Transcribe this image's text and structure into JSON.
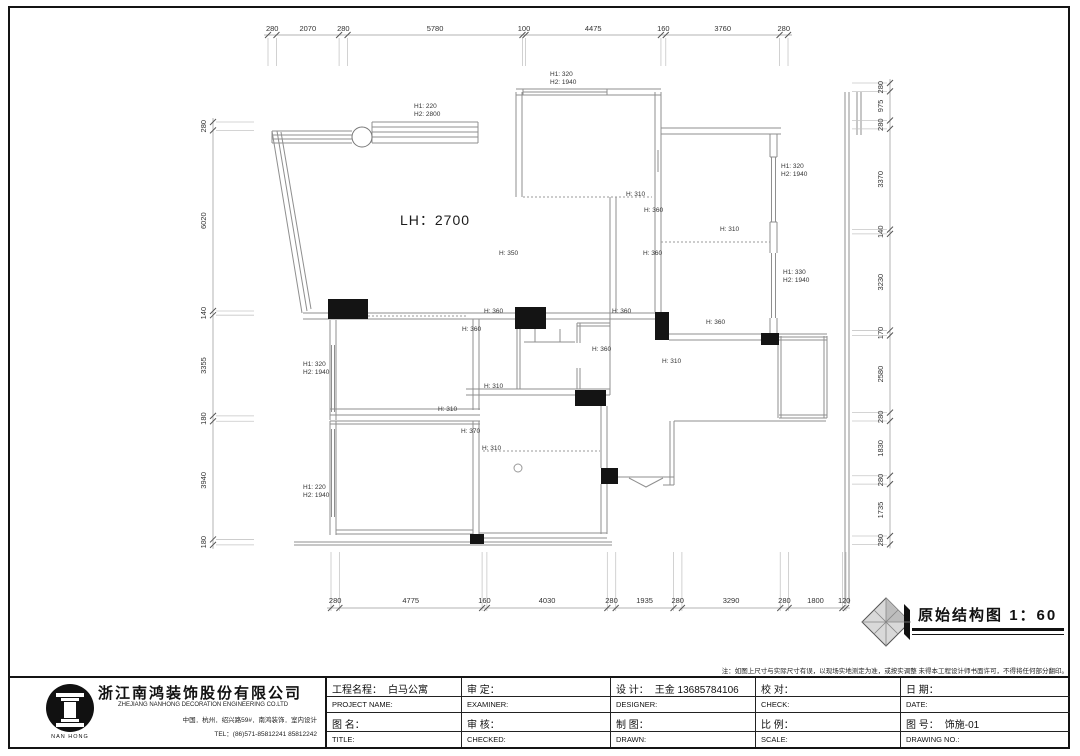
{
  "sheet": {
    "note": "注：如图上尺寸与实际尺寸有误，以现场实地测定为准，或按实调整 未得本工程设计师书面许可，不得将任何部分翻印。",
    "stamp": {
      "title": "原始结构图",
      "scale": "1：60"
    },
    "company": {
      "logo_text": "NAN HONG",
      "name": "浙江南鸿装饰股份有限公司",
      "name_en": "ZHEJIANG NANHONG DECORATION ENGINEERING CO.LTD",
      "address": "中国．杭州．绍兴路59#．南鸿装饰．室内设计",
      "tel": "TEL：(86)571-85812241 85812242"
    },
    "title_block": {
      "rows": [
        {
          "cls": "cn",
          "cells": [
            {
              "label": "工程名程：",
              "value": "白马公寓"
            },
            {
              "label": "审  定：",
              "value": ""
            },
            {
              "label": "设  计：",
              "value": "王金 13685784106"
            },
            {
              "label": "校  对：",
              "value": ""
            },
            {
              "label": "日  期：",
              "value": ""
            }
          ]
        },
        {
          "cls": "en",
          "cells": [
            {
              "label": "PROJECT NAME:",
              "value": ""
            },
            {
              "label": "EXAMINER:",
              "value": ""
            },
            {
              "label": "DESIGNER:",
              "value": ""
            },
            {
              "label": "CHECK:",
              "value": ""
            },
            {
              "label": "DATE:",
              "value": ""
            }
          ]
        },
        {
          "cls": "cn",
          "cells": [
            {
              "label": "图 名：",
              "value": ""
            },
            {
              "label": "审  核：",
              "value": ""
            },
            {
              "label": "制  图：",
              "value": ""
            },
            {
              "label": "比  例：",
              "value": ""
            },
            {
              "label": "图  号：",
              "value": "饰施-01"
            }
          ]
        },
        {
          "cls": "en",
          "cells": [
            {
              "label": "TITLE:",
              "value": ""
            },
            {
              "label": "CHECKED:",
              "value": ""
            },
            {
              "label": "DRAWN:",
              "value": ""
            },
            {
              "label": "SCALE:",
              "value": ""
            },
            {
              "label": "DRAWING NO.:",
              "value": ""
            }
          ]
        }
      ]
    }
  },
  "plan": {
    "lh_label": "LH：2700",
    "dims": {
      "top": [
        280,
        2070,
        280,
        5780,
        100,
        4475,
        160,
        3760,
        280
      ],
      "bottom": [
        280,
        4775,
        160,
        4030,
        280,
        1935,
        280,
        3290,
        280,
        1800,
        120
      ],
      "left": [
        280,
        6020,
        140,
        3355,
        180,
        3940,
        180
      ],
      "right": [
        280,
        975,
        280,
        3370,
        140,
        3230,
        170,
        2580,
        280,
        1830,
        280,
        1735,
        280
      ]
    },
    "height_labels": [
      {
        "x": 414,
        "y": 103,
        "lines": [
          "H1: 220",
          "H2: 2800"
        ]
      },
      {
        "x": 550,
        "y": 71,
        "lines": [
          "H1: 320",
          "H2: 1940"
        ]
      },
      {
        "x": 781,
        "y": 163,
        "lines": [
          "H1: 320",
          "H2: 1940"
        ]
      },
      {
        "x": 783,
        "y": 269,
        "lines": [
          "H1: 330",
          "H2: 1940"
        ]
      },
      {
        "x": 303,
        "y": 361,
        "lines": [
          "H1: 320",
          "H2: 1940"
        ]
      },
      {
        "x": 303,
        "y": 484,
        "lines": [
          "H1: 220",
          "H2: 1940"
        ]
      },
      {
        "x": 626,
        "y": 191,
        "lines": [
          "H: 310"
        ]
      },
      {
        "x": 644,
        "y": 207,
        "lines": [
          "H: 360"
        ]
      },
      {
        "x": 643,
        "y": 250,
        "lines": [
          "H: 360"
        ]
      },
      {
        "x": 720,
        "y": 226,
        "lines": [
          "H: 310"
        ]
      },
      {
        "x": 499,
        "y": 250,
        "lines": [
          "H: 350"
        ]
      },
      {
        "x": 462,
        "y": 326,
        "lines": [
          "H: 360"
        ]
      },
      {
        "x": 484,
        "y": 308,
        "lines": [
          "H: 360"
        ]
      },
      {
        "x": 612,
        "y": 308,
        "lines": [
          "H: 360"
        ]
      },
      {
        "x": 592,
        "y": 346,
        "lines": [
          "H: 360"
        ]
      },
      {
        "x": 662,
        "y": 358,
        "lines": [
          "H: 310"
        ]
      },
      {
        "x": 706,
        "y": 319,
        "lines": [
          "H: 360"
        ]
      },
      {
        "x": 484,
        "y": 383,
        "lines": [
          "H: 310"
        ]
      },
      {
        "x": 438,
        "y": 406,
        "lines": [
          "H: 310"
        ]
      },
      {
        "x": 461,
        "y": 428,
        "lines": [
          "H: 370"
        ]
      },
      {
        "x": 482,
        "y": 445,
        "lines": [
          "H: 310"
        ]
      }
    ]
  }
}
